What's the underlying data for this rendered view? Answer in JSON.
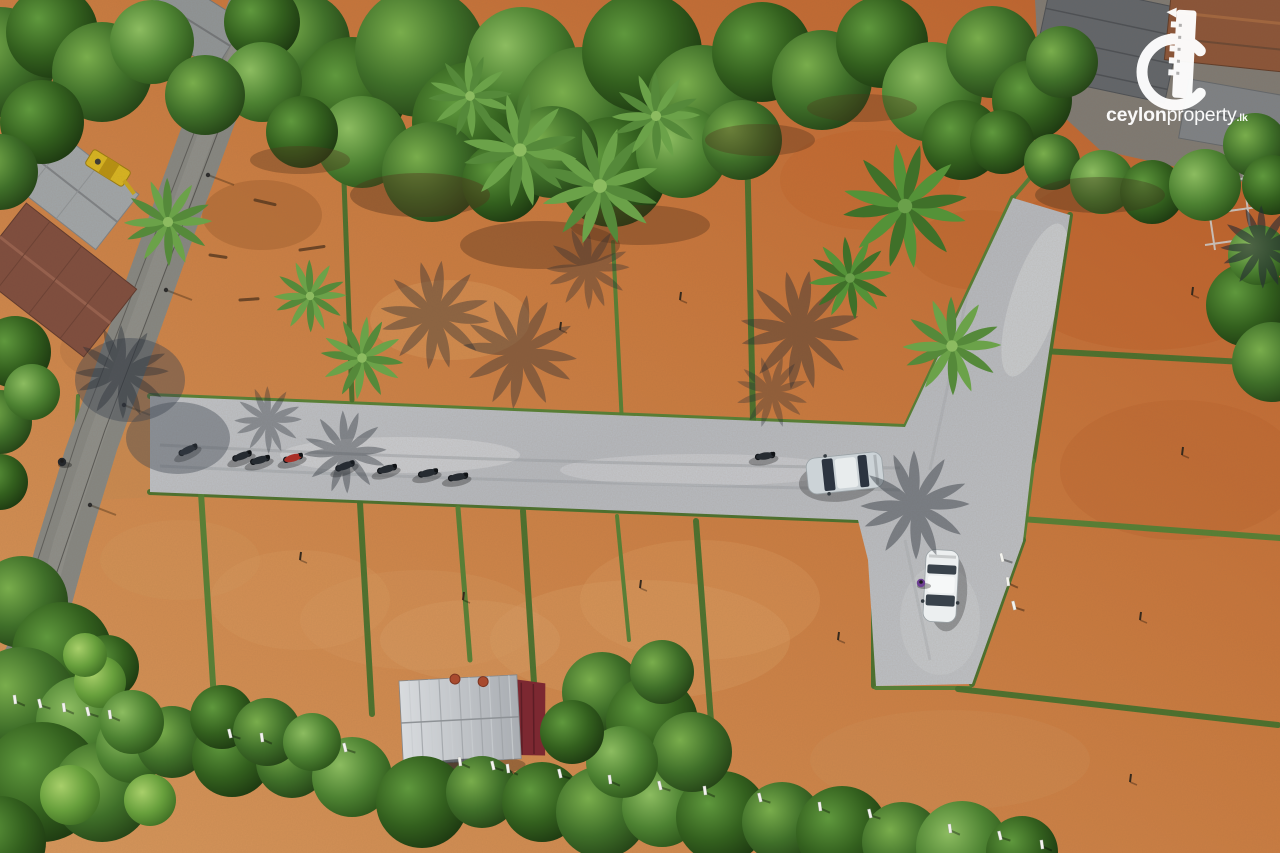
{
  "watermark": {
    "brand_bold": "ceylon",
    "brand_regular": "property",
    "brand_tld": ".lk"
  },
  "scene": {
    "description": "Aerial drone photo of a cleared land-plot subdivision: terracotta earth plots divided by green grass strips, a light gravel access road with parked motorbikes and two cars, coconut palms with shadows, houses and an asphalt road on the left, dense trees on the top and bottom edges, ceylonproperty.lk watermark top right.",
    "counts": {
      "motorbikes": 9,
      "cars": 2,
      "people": 2,
      "palm_trees": 10
    },
    "palette": {
      "dirt": "#c97a3f",
      "dirt_red": "#bd5f2b",
      "dirt_light": "#d6975c",
      "gravel": "#b9bdc3",
      "grass_strip": "#47752f",
      "asphalt": "#858783",
      "tree_dark": "#223f15",
      "tree_mid": "#3f6f29",
      "tree_light": "#79ad4c",
      "red_tarp": "#7c2831",
      "shed_roof": "#c6cacd",
      "logo_white": "#ffffff"
    },
    "tree_blobs": [
      [
        300,
        42,
        50,
        1,
        1
      ],
      [
        352,
        92,
        55,
        2,
        1
      ],
      [
        420,
        52,
        65,
        1,
        1
      ],
      [
        472,
        122,
        60,
        2,
        1
      ],
      [
        522,
        62,
        55,
        3,
        1
      ],
      [
        582,
        112,
        65,
        1,
        1
      ],
      [
        642,
        52,
        60,
        2,
        1
      ],
      [
        702,
        100,
        55,
        1,
        1
      ],
      [
        762,
        52,
        50,
        2,
        1
      ],
      [
        822,
        80,
        50,
        1,
        1
      ],
      [
        882,
        42,
        46,
        2,
        1
      ],
      [
        932,
        92,
        50,
        3,
        1
      ],
      [
        992,
        52,
        46,
        1,
        1
      ],
      [
        1032,
        100,
        40,
        2,
        1
      ],
      [
        362,
        142,
        46,
        3,
        1
      ],
      [
        432,
        172,
        50,
        1,
        1
      ],
      [
        612,
        172,
        55,
        2,
        1
      ],
      [
        682,
        152,
        46,
        3,
        1
      ],
      [
        262,
        22,
        38,
        2,
        1
      ],
      [
        1062,
        62,
        36,
        1,
        1
      ],
      [
        962,
        140,
        40,
        2,
        1
      ],
      [
        742,
        140,
        40,
        1,
        1
      ],
      [
        502,
        182,
        40,
        2,
        1
      ],
      [
        552,
        152,
        46,
        1,
        1
      ],
      [
        0,
        62,
        55,
        1,
        1
      ],
      [
        52,
        32,
        46,
        2,
        1
      ],
      [
        102,
        72,
        50,
        1,
        1
      ],
      [
        152,
        42,
        42,
        3,
        1
      ],
      [
        42,
        122,
        42,
        2,
        1
      ],
      [
        0,
        172,
        38,
        1,
        1
      ],
      [
        262,
        82,
        40,
        3,
        1
      ],
      [
        302,
        132,
        36,
        2,
        1
      ],
      [
        205,
        95,
        40,
        1,
        1
      ],
      [
        15,
        352,
        36,
        2,
        1
      ],
      [
        0,
        422,
        32,
        1,
        1
      ],
      [
        32,
        392,
        28,
        3,
        1
      ],
      [
        0,
        482,
        28,
        2,
        1
      ],
      [
        1002,
        142,
        32,
        2,
        1
      ],
      [
        1052,
        162,
        28,
        1,
        1
      ],
      [
        1102,
        182,
        32,
        3,
        1
      ],
      [
        1152,
        192,
        32,
        2,
        1
      ],
      [
        1205,
        185,
        36,
        3,
        1
      ],
      [
        1255,
        145,
        32,
        1,
        1
      ],
      [
        1272,
        185,
        30,
        2,
        1
      ],
      [
        1248,
        305,
        42,
        2,
        1
      ],
      [
        1272,
        362,
        40,
        1,
        1
      ],
      [
        1258,
        255,
        30,
        3,
        1
      ],
      [
        22,
        602,
        46,
        1,
        1
      ],
      [
        62,
        652,
        50,
        2,
        1
      ],
      [
        22,
        702,
        55,
        1,
        1
      ],
      [
        82,
        722,
        46,
        3,
        1
      ],
      [
        42,
        782,
        60,
        2,
        1
      ],
      [
        102,
        792,
        50,
        1,
        1
      ],
      [
        0,
        842,
        46,
        2,
        1
      ],
      [
        132,
        747,
        36,
        3,
        1
      ],
      [
        107,
        667,
        32,
        2,
        1
      ],
      [
        100,
        682,
        26,
        4,
        1
      ],
      [
        85,
        655,
        22,
        4,
        1
      ],
      [
        172,
        742,
        36,
        1,
        2
      ],
      [
        232,
        757,
        40,
        2,
        2
      ],
      [
        292,
        762,
        36,
        1,
        2
      ],
      [
        352,
        777,
        40,
        3,
        2
      ],
      [
        422,
        802,
        46,
        2,
        2
      ],
      [
        482,
        792,
        36,
        1,
        2
      ],
      [
        542,
        802,
        40,
        2,
        2
      ],
      [
        602,
        812,
        46,
        1,
        2
      ],
      [
        662,
        807,
        40,
        3,
        2
      ],
      [
        722,
        817,
        46,
        2,
        2
      ],
      [
        782,
        822,
        40,
        1,
        2
      ],
      [
        842,
        832,
        46,
        2,
        2
      ],
      [
        902,
        842,
        40,
        1,
        2
      ],
      [
        962,
        847,
        46,
        3,
        2
      ],
      [
        1022,
        852,
        36,
        2,
        2
      ],
      [
        132,
        722,
        32,
        3,
        2
      ],
      [
        602,
        692,
        40,
        1,
        2
      ],
      [
        652,
        722,
        46,
        2,
        2
      ],
      [
        692,
        752,
        40,
        1,
        2
      ],
      [
        622,
        762,
        36,
        3,
        2
      ],
      [
        572,
        732,
        32,
        2,
        2
      ],
      [
        662,
        672,
        32,
        1,
        2
      ],
      [
        222,
        717,
        32,
        2,
        2
      ],
      [
        267,
        732,
        34,
        1,
        2
      ],
      [
        312,
        742,
        29,
        3,
        2
      ],
      [
        70,
        795,
        30,
        4,
        2
      ],
      [
        150,
        800,
        26,
        4,
        2
      ]
    ],
    "grass_strips": [
      [
        150,
        396,
        905,
        427,
        6
      ],
      [
        150,
        492,
        858,
        520,
        6
      ],
      [
        903,
        433,
        1013,
        198,
        6
      ],
      [
        1070,
        215,
        1033,
        461,
        6
      ],
      [
        1033,
        461,
        1023,
        540,
        5
      ],
      [
        1023,
        540,
        972,
        684,
        6
      ],
      [
        862,
        518,
        874,
        560,
        5
      ],
      [
        874,
        560,
        874,
        686,
        6
      ],
      [
        876,
        688,
        970,
        688,
        4
      ],
      [
        343,
        154,
        352,
        400,
        5
      ],
      [
        613,
        242,
        622,
        424,
        4
      ],
      [
        746,
        97,
        753,
        420,
        6
      ],
      [
        1013,
        198,
        1045,
        160,
        4
      ],
      [
        1043,
        351,
        1280,
        364,
        6
      ],
      [
        1007,
        518,
        1280,
        538,
        6
      ],
      [
        958,
        689,
        1278,
        725,
        6
      ],
      [
        201,
        493,
        214,
        700,
        6
      ],
      [
        360,
        503,
        372,
        714,
        6
      ],
      [
        458,
        508,
        470,
        660,
        5
      ],
      [
        523,
        511,
        537,
        730,
        6
      ],
      [
        617,
        516,
        629,
        640,
        4
      ],
      [
        696,
        521,
        713,
        748,
        6
      ],
      [
        78,
        396,
        68,
        618,
        4
      ]
    ],
    "palms": [
      [
        520,
        150,
        1.1,
        10,
        "A"
      ],
      [
        600,
        186,
        1.15,
        40,
        "A"
      ],
      [
        656,
        116,
        0.85,
        0,
        "A"
      ],
      [
        470,
        96,
        0.8,
        20,
        "A"
      ],
      [
        905,
        206,
        1.2,
        15,
        "B"
      ],
      [
        850,
        278,
        0.8,
        50,
        "B"
      ],
      [
        952,
        346,
        0.95,
        0,
        "A"
      ],
      [
        362,
        358,
        0.8,
        30,
        "A"
      ],
      [
        310,
        296,
        0.7,
        0,
        "A"
      ],
      [
        168,
        222,
        0.85,
        0,
        "A"
      ]
    ],
    "palm_shadows": [
      [
        435,
        315,
        1.05,
        8,
        0.38
      ],
      [
        520,
        352,
        1.1,
        30,
        0.38
      ],
      [
        588,
        268,
        0.8,
        0,
        0.34
      ],
      [
        800,
        330,
        1.15,
        10,
        0.4
      ],
      [
        772,
        392,
        0.7,
        40,
        0.32
      ],
      [
        915,
        505,
        1.05,
        0,
        0.42
      ],
      [
        345,
        452,
        0.8,
        20,
        0.38
      ],
      [
        268,
        420,
        0.65,
        0,
        0.34
      ],
      [
        122,
        372,
        0.9,
        0,
        0.4
      ],
      [
        1262,
        247,
        0.8,
        0,
        0.6
      ]
    ],
    "bikes": [
      [
        188,
        450,
        -25,
        "dark"
      ],
      [
        242,
        456,
        -20,
        "dark"
      ],
      [
        260,
        460,
        -15,
        "dark"
      ],
      [
        293,
        458,
        -15,
        "red"
      ],
      [
        345,
        466,
        -20,
        "dark"
      ],
      [
        387,
        469,
        -15,
        "dark"
      ],
      [
        428,
        473,
        -12,
        "dark"
      ],
      [
        458,
        477,
        -10,
        "dark"
      ],
      [
        765,
        456,
        -8,
        "dark"
      ]
    ],
    "cars": [
      {
        "x": 845,
        "y": 473,
        "rot": -6,
        "len": 76,
        "wid": 36,
        "body": "#ccd3d7",
        "roof": "#e8eced",
        "glass": "#2c3440"
      },
      {
        "x": 941,
        "y": 586,
        "rot": -87,
        "len": 72,
        "wid": 33,
        "body": "#eceff0",
        "roof": "#f6f8f8",
        "glass": "#39424b"
      }
    ],
    "people": [
      [
        62,
        462,
        "#24272b"
      ],
      [
        921,
        583,
        "#6d3f93"
      ]
    ],
    "posts": [
      [
        15,
        700
      ],
      [
        40,
        704
      ],
      [
        64,
        708
      ],
      [
        88,
        712
      ],
      [
        110,
        715
      ],
      [
        230,
        734
      ],
      [
        262,
        738
      ],
      [
        345,
        748
      ],
      [
        460,
        762
      ],
      [
        493,
        766
      ],
      [
        508,
        769
      ],
      [
        560,
        774
      ],
      [
        610,
        780
      ],
      [
        660,
        786
      ],
      [
        705,
        791
      ],
      [
        760,
        798
      ],
      [
        820,
        807
      ],
      [
        870,
        814
      ],
      [
        950,
        829
      ],
      [
        1000,
        836
      ],
      [
        1042,
        845
      ],
      [
        1002,
        558
      ],
      [
        1008,
        582
      ],
      [
        1014,
        606
      ]
    ],
    "pegs": [
      [
        1140,
        620
      ],
      [
        1130,
        782
      ],
      [
        1182,
        455
      ],
      [
        1192,
        295
      ],
      [
        640,
        588
      ],
      [
        838,
        640
      ],
      [
        463,
        600
      ],
      [
        300,
        560
      ],
      [
        680,
        300
      ],
      [
        560,
        330
      ]
    ],
    "stains": [
      [
        1150,
        260,
        150,
        90,
        "#b85a24",
        0.3
      ],
      [
        1180,
        470,
        120,
        70,
        "#b55a26",
        0.25
      ],
      [
        870,
        180,
        90,
        50,
        "#c06028",
        0.3
      ],
      [
        640,
        640,
        150,
        60,
        "#dca268",
        0.3
      ],
      [
        420,
        620,
        120,
        50,
        "#d89c60",
        0.28
      ],
      [
        950,
        760,
        140,
        50,
        "#d1945a",
        0.25
      ],
      [
        180,
        560,
        80,
        40,
        "#d49a60",
        0.25
      ],
      [
        470,
        640,
        90,
        40,
        "#dba36a",
        0.3
      ],
      [
        262,
        215,
        60,
        35,
        "#8a5126",
        0.3
      ],
      [
        110,
        350,
        50,
        30,
        "#a86a3a",
        0.3
      ],
      [
        450,
        320,
        80,
        40,
        "#e2a468",
        0.3
      ],
      [
        700,
        600,
        120,
        60,
        "#dfa368",
        0.25
      ],
      [
        300,
        600,
        90,
        50,
        "#dca064",
        0.25
      ],
      [
        980,
        250,
        70,
        40,
        "#b65c26",
        0.3
      ]
    ],
    "sticks": [
      [
        255,
        200,
        20,
        30
      ],
      [
        300,
        250,
        24,
        -20
      ],
      [
        340,
        172,
        28,
        15
      ],
      [
        380,
        150,
        22,
        35
      ],
      [
        240,
        300,
        18,
        -10
      ],
      [
        210,
        255,
        16,
        20
      ]
    ],
    "wire_poles": [
      [
        250,
        60
      ],
      [
        208,
        175
      ],
      [
        166,
        290
      ],
      [
        124,
        405
      ],
      [
        90,
        505
      ],
      [
        56,
        615
      ]
    ]
  }
}
